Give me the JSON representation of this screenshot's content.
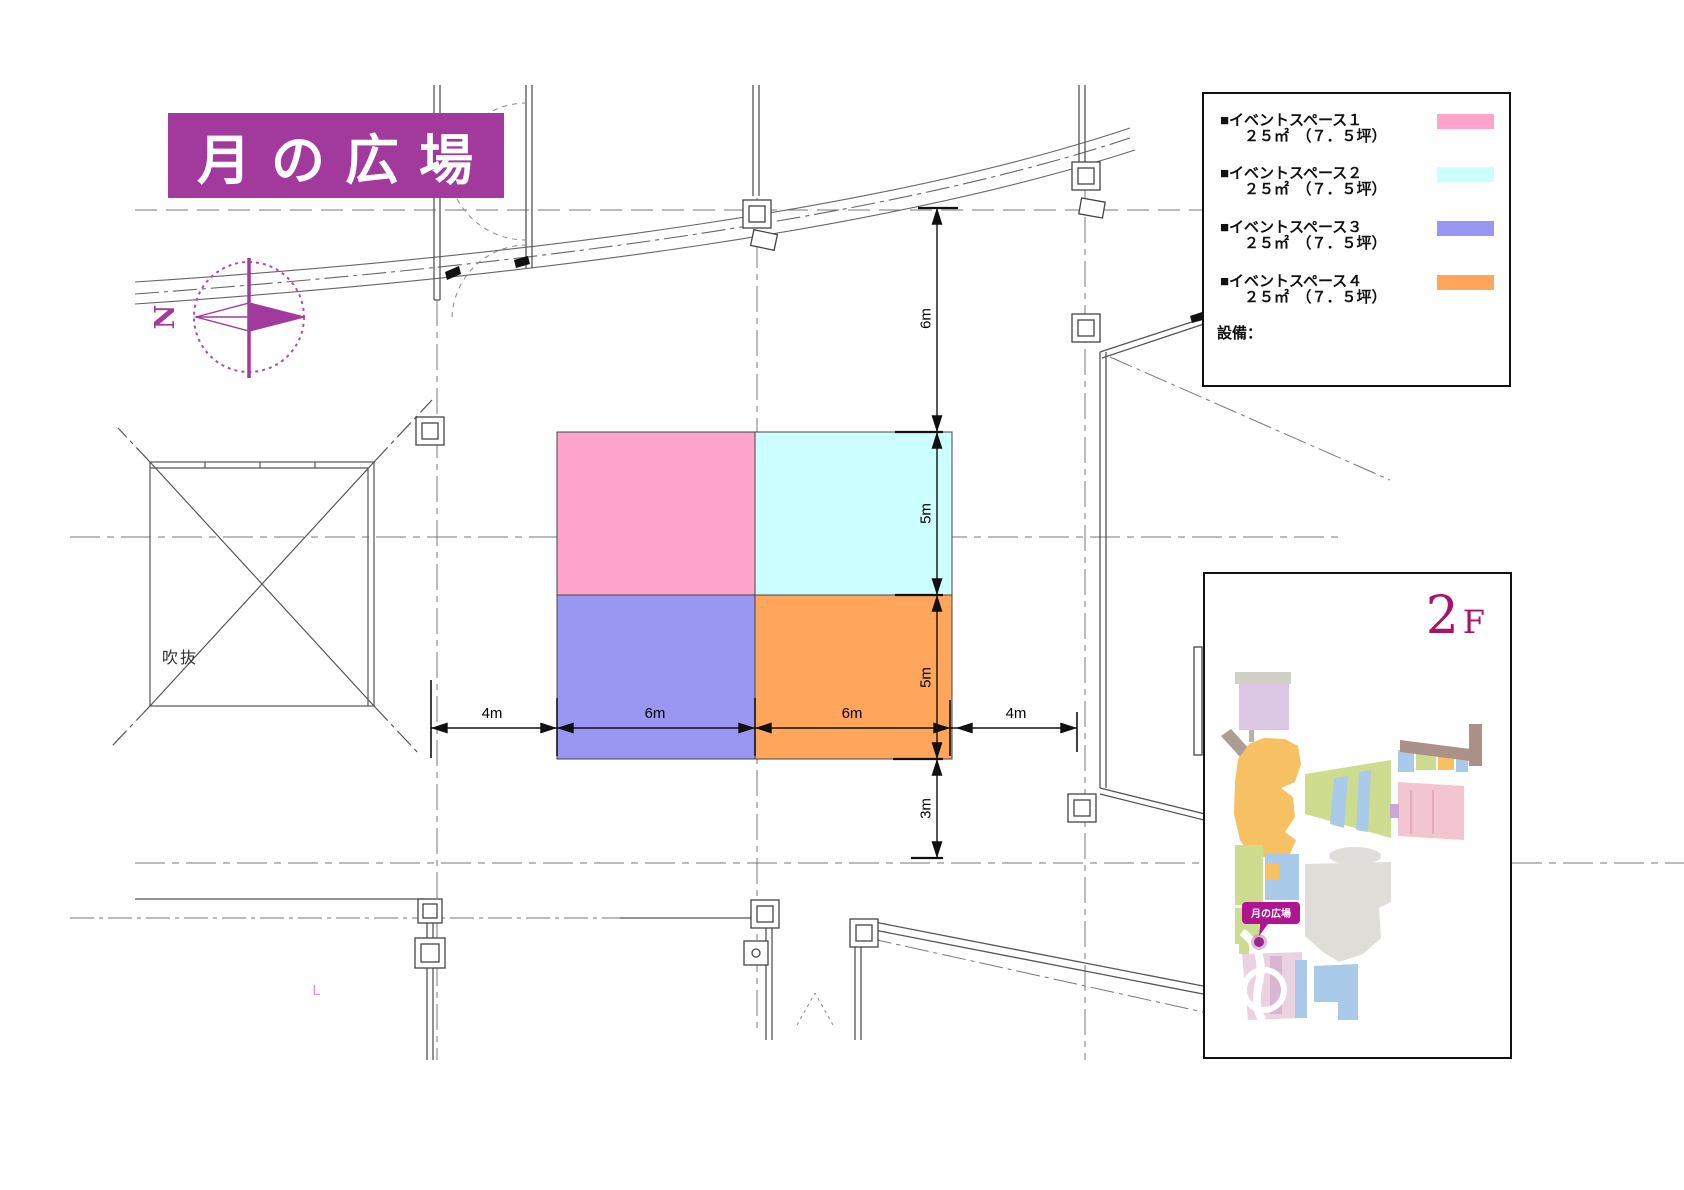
{
  "title": "月の広場",
  "compass": {
    "north_label": "N"
  },
  "legend": {
    "items": [
      {
        "label": "■イベントスペース１",
        "area": "２５㎡　（７．５坪）",
        "color": "#ffa5cb"
      },
      {
        "label": "■イベントスペース２",
        "area": "２５㎡　（７．５坪）",
        "color": "#ccffff"
      },
      {
        "label": "■イベントスペース３",
        "area": "２５㎡　（７．５坪）",
        "color": "#9a97f2"
      },
      {
        "label": "■イベントスペース４",
        "area": "２５㎡　（７．５坪）",
        "color": "#ffa55c"
      }
    ],
    "equipment_label": "設備："
  },
  "plan": {
    "atrium_label": "吹抜",
    "corner_mark": "L",
    "dimensions": {
      "vertical": [
        "6m",
        "5m",
        "5m",
        "3m"
      ],
      "horizontal": [
        "4m",
        "6m",
        "6m",
        "4m"
      ]
    }
  },
  "inset": {
    "floor_number": "2",
    "floor_letter": "F",
    "location_tag": "月の広場"
  }
}
